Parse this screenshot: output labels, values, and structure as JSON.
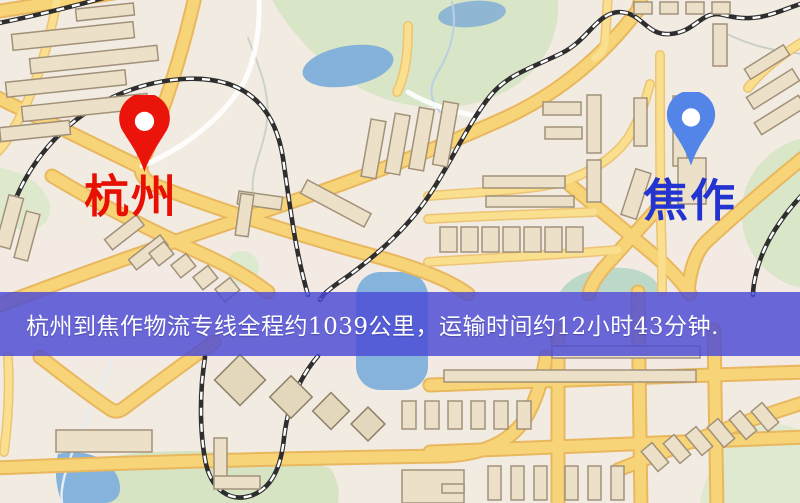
{
  "banner": {
    "text": "杭州到焦作物流专线全程约1039公里，运输时间约12小时43分钟.",
    "background_color": "#4a4ad5",
    "text_color": "#ffffff"
  },
  "origin_marker": {
    "label": "杭州",
    "pin_color": "#eb140b",
    "pin_hole_color": "#ffffff",
    "label_color": "#e80f03"
  },
  "destination_marker": {
    "label": "焦作",
    "pin_color": "#5285e7",
    "pin_hole_color": "#ffffff",
    "label_color": "#2334d0"
  },
  "map_colors": {
    "background": "#f2ebe2",
    "road_fill": "#f8d478",
    "road_casing": "#e8b75e",
    "minor_road_fill": "#fadf8e",
    "white_road": "#ffffff",
    "building_fill": "#ece1c8",
    "building_stroke": "#a2917a",
    "park_green": "#d8e5c6",
    "water_blue": "#84b2da",
    "railway_dark": "#2e2e2e",
    "railway_dash": "#ffffff"
  }
}
